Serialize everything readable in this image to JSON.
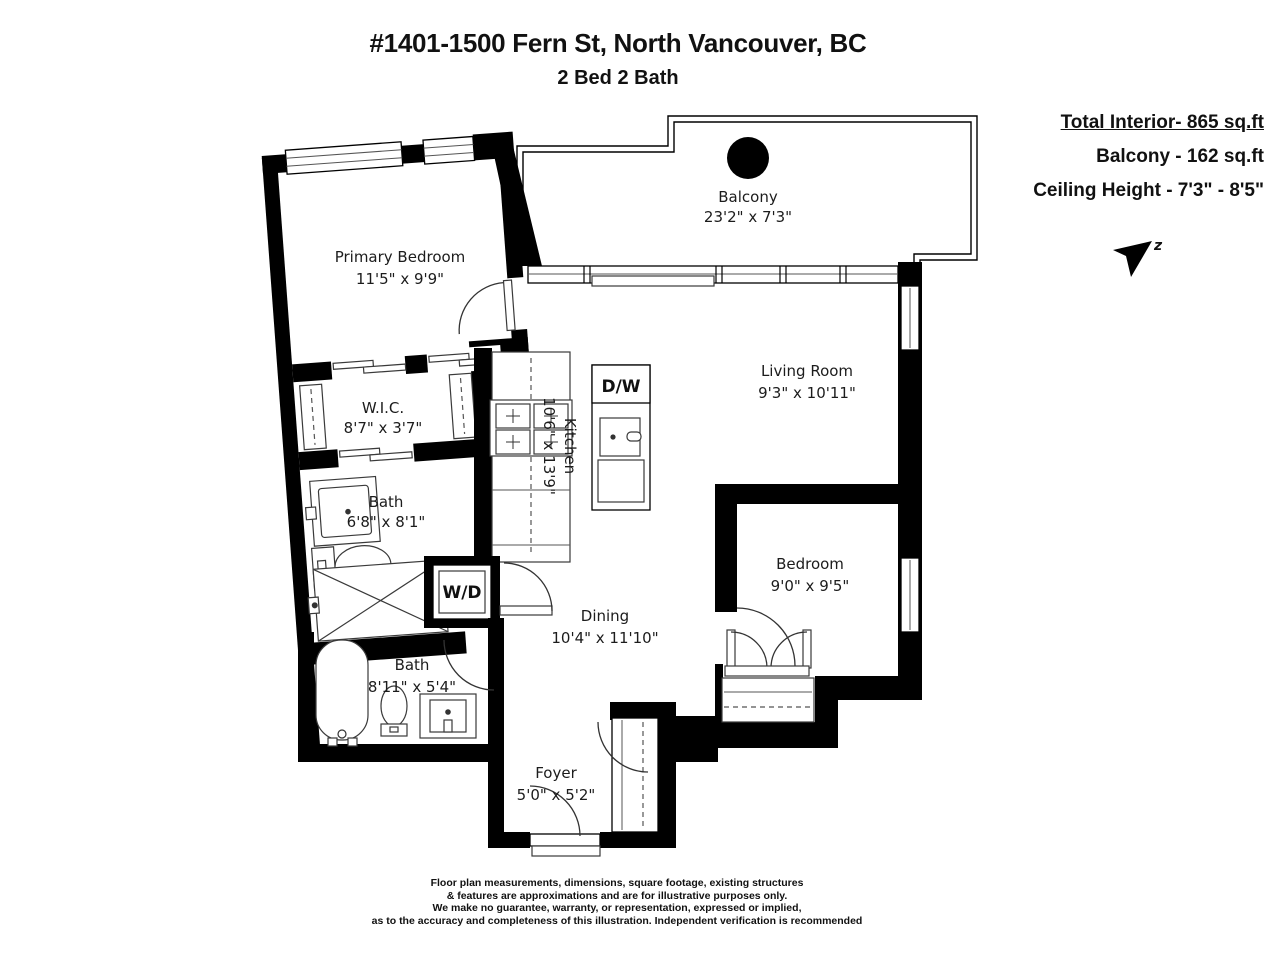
{
  "header": {
    "title": "#1401-1500 Fern St, North Vancouver, BC",
    "subtitle": "2 Bed 2 Bath"
  },
  "info": {
    "total_interior": "Total Interior- 865 sq.ft",
    "balcony_area": "Balcony - 162 sq.ft",
    "ceiling_height": "Ceiling Height - 7'3\" - 8'5\"",
    "north_letter": "z"
  },
  "rooms": {
    "balcony": {
      "name": "Balcony",
      "dims": "23'2\" x 7'3\""
    },
    "primary_bedroom": {
      "name": "Primary Bedroom",
      "dims": "11'5\" x 9'9\""
    },
    "wic": {
      "name": "W.I.C.",
      "dims": "8'7\" x 3'7\""
    },
    "ensuite_bath": {
      "name": "Bath",
      "dims": "6'8\" x 8'1\""
    },
    "kitchen": {
      "name": "Kitchen",
      "dims": "10'6\" x 13'9\""
    },
    "living_room": {
      "name": "Living Room",
      "dims": "9'3\" x 10'11\""
    },
    "bedroom": {
      "name": "Bedroom",
      "dims": "9'0\" x 9'5\""
    },
    "dining": {
      "name": "Dining",
      "dims": "10'4\" x 11'10\""
    },
    "main_bath": {
      "name": "Bath",
      "dims": "8'11\" x 5'4\""
    },
    "foyer": {
      "name": "Foyer",
      "dims": "5'0\" x 5'2\""
    }
  },
  "appliances": {
    "dishwasher": "D/W",
    "washer_dryer": "W/D"
  },
  "colors": {
    "wall": "#000000",
    "background": "#ffffff"
  },
  "footer": {
    "lines": [
      "Floor plan measurements, dimensions, square footage, existing structures",
      "& features are approximations and are for illustrative purposes only.",
      "We make no guarantee, warranty, or representation, expressed or implied,",
      "as to the accuracy and completeness of this illustration. Independent verification is recommended"
    ]
  }
}
